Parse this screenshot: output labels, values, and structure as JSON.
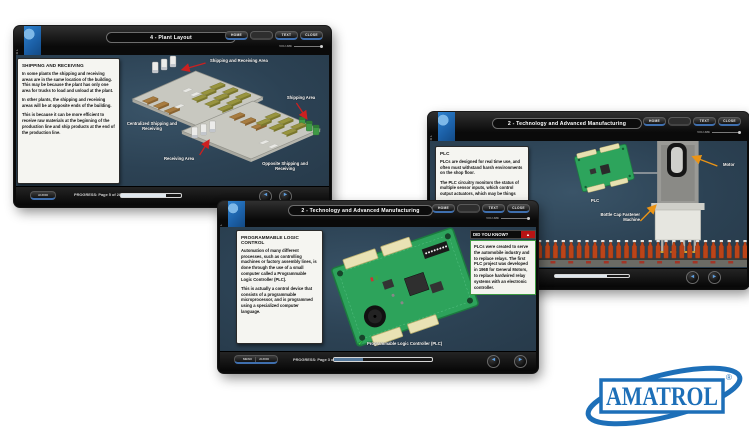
{
  "icons": {
    "nav_prev": "◄",
    "nav_next": "►",
    "check": "✔",
    "alert": "▲"
  },
  "colors": {
    "brand_blue": "#1d6fb8",
    "accent_blue": "#3f6fae",
    "content_bg": "#2c4254",
    "arrow_red": "#cc2020",
    "arrow_orange": "#eb9416",
    "board_green": "#2da35b",
    "bottle_orange": "#b8441a"
  },
  "player": {
    "brand_vertical": "AMATROL",
    "volume_label": "VOLUME",
    "buttons": {
      "home": "HOME",
      "glossary": "",
      "text": "TEXT",
      "close": "CLOSE"
    },
    "bottom": {
      "menu": "MENU",
      "audio": "AUDIO"
    }
  },
  "windows": {
    "plant_layout": {
      "title": "4 - Plant Layout",
      "panel": {
        "heading": "SHIPPING AND RECEIVING",
        "p1": "In some plants the shipping and receiving areas are in the same location of the building. This may be because the plant has only one area for trucks to load and unload at the plant.",
        "p2": "In other plants, the shipping and receiving areas will be at opposite ends of the building.",
        "p3": "This is because it can be more efficient to receive raw materials at the beginning of the production line and ship products at the end of the production line."
      },
      "labels": {
        "shipping_receiving_area": "Shipping and Receiving Area",
        "centralized": "Centralized Shipping and Receiving",
        "shipping_area": "Shipping Area",
        "receiving_area": "Receiving Area",
        "opposite": "Opposite Shipping and Receiving"
      },
      "progress": "PROGRESS: Page 5 of 28"
    },
    "plc_machine": {
      "title": "2 - Technology and Advanced Manufacturing",
      "panel": {
        "heading": "PLC",
        "p1": "PLCs are designed for real time use, and often must withstand harsh environments on the shop floor.",
        "p2": "The PLC circuitry monitors the status of multiple sensor inputs, which control output actuators, which may be things"
      },
      "labels": {
        "plc": "PLC",
        "motor": "Motor",
        "machine": "Bottle Cap Fastener Machine"
      },
      "progress": "PROGRESS: Page 4 of 17"
    },
    "plc_board": {
      "title": "2 - Technology and Advanced Manufacturing",
      "panel": {
        "heading": "PROGRAMMABLE LOGIC CONTROL",
        "p1": "Automation of many different processes, such as controlling machines or factory assembly lines, is done through the use of a small computer called a Programmable Logic Controller (PLC).",
        "p2": "This is actually a control device that consists of a programmable microprocessor, and is programmed using a specialized computer language."
      },
      "did_you_know": {
        "header": "DID YOU KNOW?",
        "body": "PLCs were created to serve the automobile industry and to replace relays. The first PLC project was developed in 1968 for General Motors, to replace hardwired relay systems with an electronic controller."
      },
      "board_label": "Programmable Logic Controller (PLC)",
      "progress": "PROGRESS: Page 3 of 17"
    }
  },
  "logo": {
    "brand": "AMATROL",
    "registered": "®"
  }
}
